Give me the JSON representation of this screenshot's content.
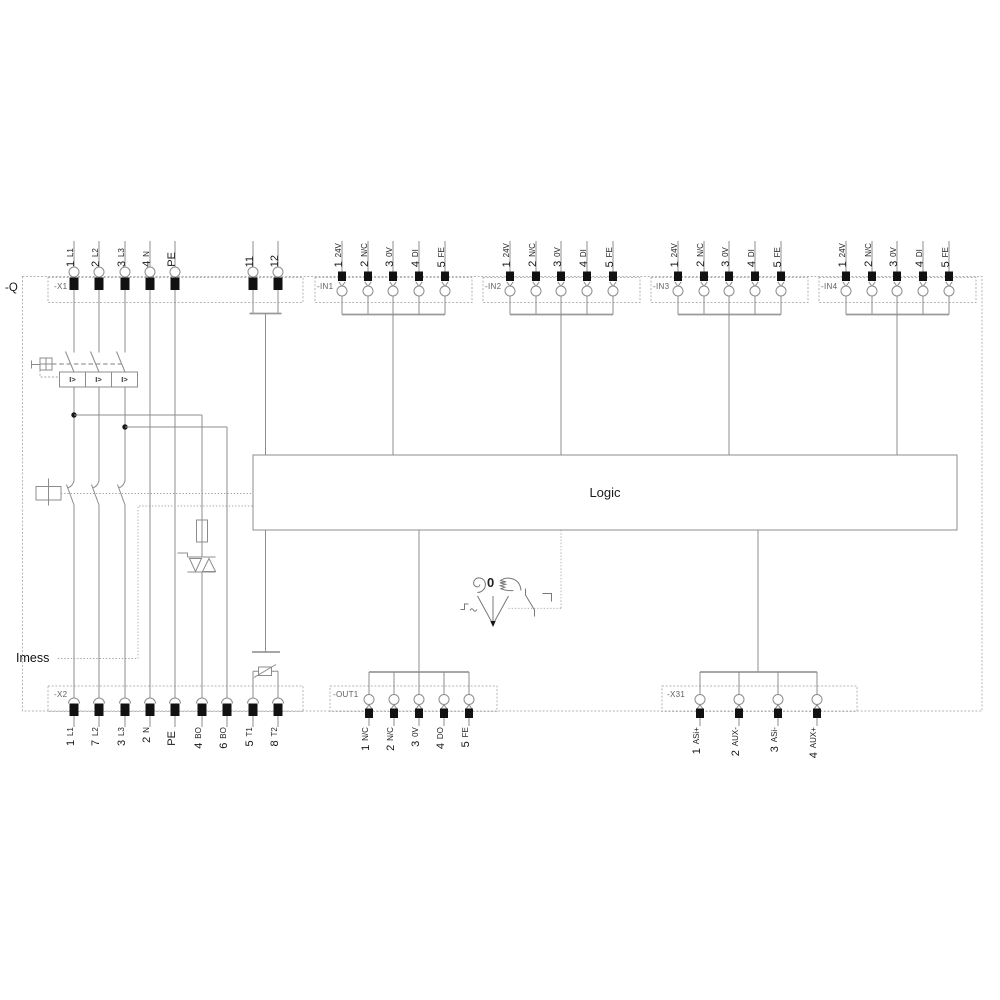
{
  "diagram": {
    "enclosure_label": "-Q",
    "logic_label": "Logic",
    "current_measure_label": "Imess",
    "selector_zero_label": "0",
    "overcurrent_trip_label": "I>"
  },
  "connectors": {
    "x1": {
      "label": "-X1",
      "pins": [
        {
          "num": "1",
          "name": "L1"
        },
        {
          "num": "2",
          "name": "L2"
        },
        {
          "num": "3",
          "name": "L3"
        },
        {
          "num": "4",
          "name": "N"
        },
        {
          "num": "PE",
          "name": ""
        },
        {
          "num": "11",
          "name": ""
        },
        {
          "num": "12",
          "name": ""
        }
      ]
    },
    "in1": {
      "label": "-IN1",
      "pins": [
        {
          "num": "1",
          "name": "24V"
        },
        {
          "num": "2",
          "name": "N/C"
        },
        {
          "num": "3",
          "name": "0V"
        },
        {
          "num": "4",
          "name": "DI"
        },
        {
          "num": "5",
          "name": "FE"
        }
      ]
    },
    "in2": {
      "label": "-IN2",
      "pins": [
        {
          "num": "1",
          "name": "24V"
        },
        {
          "num": "2",
          "name": "N/C"
        },
        {
          "num": "3",
          "name": "0V"
        },
        {
          "num": "4",
          "name": "DI"
        },
        {
          "num": "5",
          "name": "FE"
        }
      ]
    },
    "in3": {
      "label": "-IN3",
      "pins": [
        {
          "num": "1",
          "name": "24V"
        },
        {
          "num": "2",
          "name": "N/C"
        },
        {
          "num": "3",
          "name": "0V"
        },
        {
          "num": "4",
          "name": "DI"
        },
        {
          "num": "5",
          "name": "FE"
        }
      ]
    },
    "in4": {
      "label": "-IN4",
      "pins": [
        {
          "num": "1",
          "name": "24V"
        },
        {
          "num": "2",
          "name": "N/C"
        },
        {
          "num": "3",
          "name": "0V"
        },
        {
          "num": "4",
          "name": "DI"
        },
        {
          "num": "5",
          "name": "FE"
        }
      ]
    },
    "x2": {
      "label": "-X2",
      "pins": [
        {
          "num": "1",
          "name": "L1"
        },
        {
          "num": "7",
          "name": "L2"
        },
        {
          "num": "3",
          "name": "L3"
        },
        {
          "num": "2",
          "name": "N"
        },
        {
          "num": "PE",
          "name": ""
        },
        {
          "num": "4",
          "name": "BO"
        },
        {
          "num": "6",
          "name": "BO"
        },
        {
          "num": "5",
          "name": "T1"
        },
        {
          "num": "8",
          "name": "T2"
        }
      ]
    },
    "out1": {
      "label": "-OUT1",
      "pins": [
        {
          "num": "1",
          "name": "N/C"
        },
        {
          "num": "2",
          "name": "N/C"
        },
        {
          "num": "3",
          "name": "0V"
        },
        {
          "num": "4",
          "name": "DO"
        },
        {
          "num": "5",
          "name": "FE"
        }
      ]
    },
    "x31": {
      "label": "-X31",
      "pins": [
        {
          "num": "1",
          "name": "ASi+"
        },
        {
          "num": "2",
          "name": "AUX-"
        },
        {
          "num": "3",
          "name": "ASi-"
        },
        {
          "num": "4",
          "name": "AUX+"
        }
      ]
    }
  }
}
